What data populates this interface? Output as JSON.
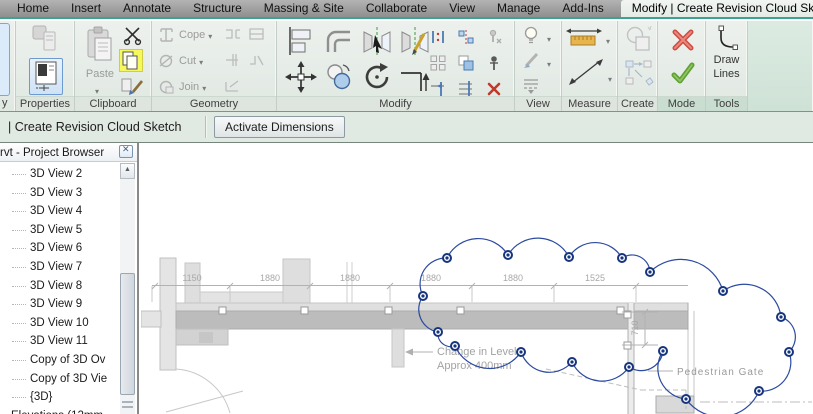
{
  "colors": {
    "accent_teal": "#3aa392",
    "selection_blue": "#6d9bd1",
    "highlight_yellow": "#f7f75e",
    "cancel_red": "#cf4a3f",
    "finish_green": "#61a232",
    "cloud_blue": "#2c4aa0",
    "annotation_gray": "#a2a2a2"
  },
  "tabs": {
    "items": [
      "Home",
      "Insert",
      "Annotate",
      "Structure",
      "Massing & Site",
      "Collaborate",
      "View",
      "Manage",
      "Add-Ins"
    ],
    "active": "Modify | Create Revision Cloud Sketch"
  },
  "ribbon": {
    "select_button_partial": "y",
    "panels": {
      "properties": {
        "label": "Properties"
      },
      "clipboard": {
        "label": "Clipboard",
        "paste": "Paste"
      },
      "geometry": {
        "label": "Geometry",
        "rows": [
          "Cope",
          "Cut",
          "Join"
        ]
      },
      "modify": {
        "label": "Modify"
      },
      "view": {
        "label": "View"
      },
      "measure": {
        "label": "Measure"
      },
      "create": {
        "label": "Create"
      },
      "mode": {
        "label": "Mode"
      },
      "tools": {
        "label": "Tools",
        "draw_line1": "Draw",
        "draw_line2": "Lines"
      }
    },
    "icons": {
      "mode": [
        "cancel-x-icon",
        "finish-check-icon"
      ],
      "clipboard": [
        "paste-icon",
        "cut-scissors-icon",
        "copy-icon",
        "match-properties-icon"
      ],
      "modify": [
        "align-icon",
        "offset-icon",
        "mirror-pick-axis-icon",
        "mirror-draw-axis-icon",
        "move-icon",
        "copy-icon",
        "rotate-icon",
        "trim-extend-corner-icon",
        "split-icon",
        "split-gap-icon",
        "unpin-icon",
        "array-icon",
        "scale-icon",
        "pin-icon",
        "trim-single-icon",
        "trim-multiple-icon",
        "delete-icon"
      ]
    }
  },
  "options_bar": {
    "context_label": "| Create Revision Cloud Sketch",
    "activate_dimensions": "Activate Dimensions"
  },
  "project_browser": {
    "title": "rvt - Project Browser",
    "items": [
      {
        "label": "3D View 2",
        "indent": 2
      },
      {
        "label": "3D View 3",
        "indent": 2
      },
      {
        "label": "3D View 4",
        "indent": 2
      },
      {
        "label": "3D View 5",
        "indent": 2
      },
      {
        "label": "3D View 6",
        "indent": 2
      },
      {
        "label": "3D View 7",
        "indent": 2
      },
      {
        "label": "3D View 8",
        "indent": 2
      },
      {
        "label": "3D View 9",
        "indent": 2
      },
      {
        "label": "3D View 10",
        "indent": 2
      },
      {
        "label": "3D View 11",
        "indent": 2
      },
      {
        "label": "Copy of 3D Ov",
        "indent": 2
      },
      {
        "label": "Copy of 3D Vie",
        "indent": 2
      },
      {
        "label": "{3D}",
        "indent": 2
      },
      {
        "label": "Elevations (12mm",
        "indent": 1
      }
    ]
  },
  "canvas": {
    "dimensions": [
      "1150",
      "1880",
      "1880",
      "1880",
      "1880",
      "1525"
    ],
    "vertical_dimension": "710",
    "annotations": {
      "change_line1": "Change in Level",
      "change_line2": "Approx 400mm",
      "pedestrian_gate": "Pedestrian Gate"
    }
  }
}
